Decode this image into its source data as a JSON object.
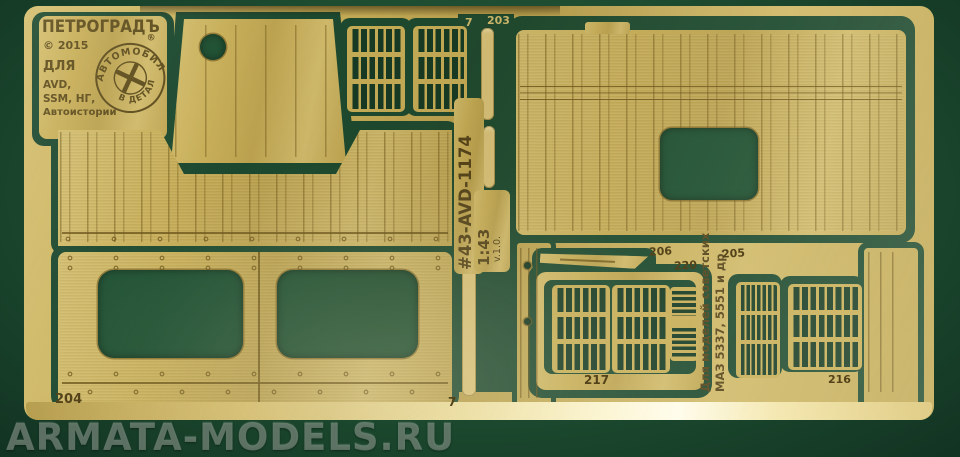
{
  "photo": {
    "watermark": "ARMATA-MODELS.RU"
  },
  "plate": {
    "brand": "ПЕТРОГРАДЪ",
    "copyright": "© 2015",
    "for_word": "ДЛЯ",
    "clients_line1": "AVD,",
    "clients_line2": "SSM, НГ,",
    "clients_line3": "Автоистории",
    "stamp_top": "АВТОМОБИЛЬ",
    "stamp_bottom": "В ДЕТАЛЯХ",
    "stamp_reg": "®"
  },
  "sheet": {
    "set_code": "#43-AVD-1174",
    "scale": "1:43",
    "version": "v.1.0.",
    "application_line1": "Для моделей советских",
    "application_line2": "МАЗ 5337, 5551 и др."
  },
  "part_numbers": {
    "top_sprue": "7",
    "p203": "203",
    "p204": "204",
    "p205": "205",
    "p206": "206",
    "p216": "216",
    "p217": "217",
    "p220": "220",
    "bottom_sprue": "7"
  },
  "colors": {
    "brass": "#c7ae58",
    "felt_green": "#1d4c30",
    "etch_line": "#7a6324"
  }
}
